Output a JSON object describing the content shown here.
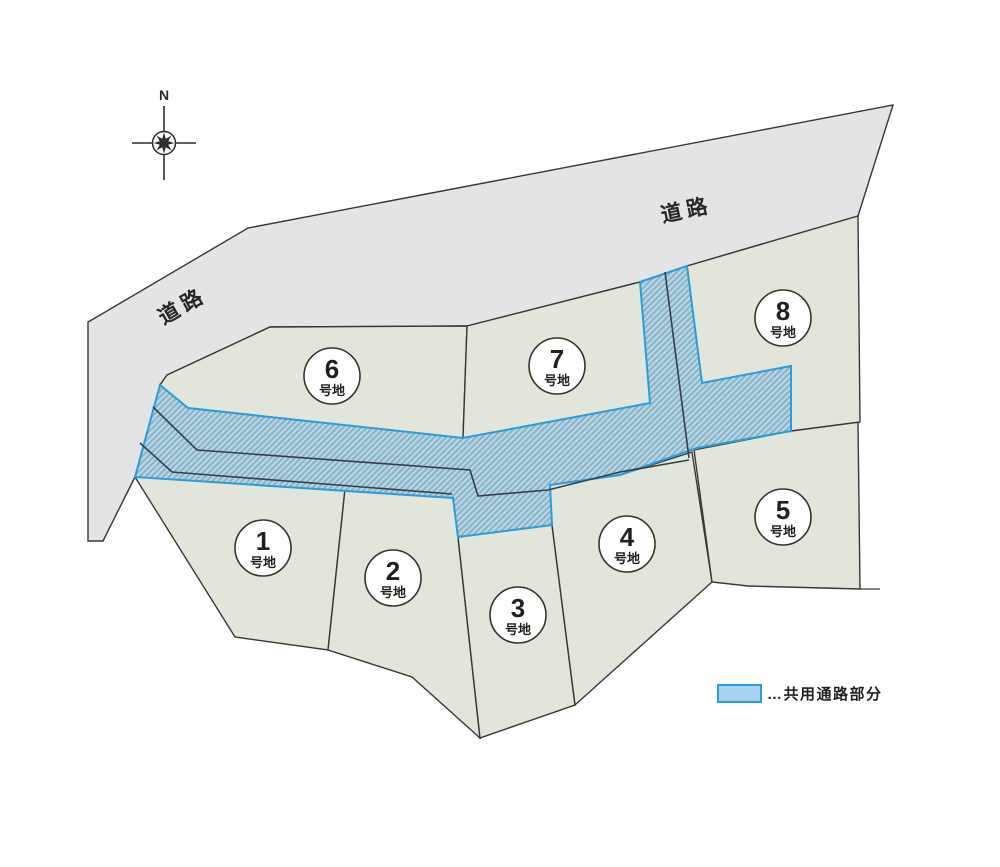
{
  "title": "分譲地区画図",
  "compass": {
    "north_label": "N"
  },
  "roads": [
    {
      "label": "道路",
      "position": "upper-left"
    },
    {
      "label": "道路",
      "position": "upper-right"
    }
  ],
  "plots": [
    {
      "number": "1",
      "suffix": "号地"
    },
    {
      "number": "2",
      "suffix": "号地"
    },
    {
      "number": "3",
      "suffix": "号地"
    },
    {
      "number": "4",
      "suffix": "号地"
    },
    {
      "number": "5",
      "suffix": "号地"
    },
    {
      "number": "6",
      "suffix": "号地"
    },
    {
      "number": "7",
      "suffix": "号地"
    },
    {
      "number": "8",
      "suffix": "号地"
    }
  ],
  "legend": {
    "label": "…共用通路部分"
  },
  "colors": {
    "road_fill": "#e4e4e6",
    "plot_fill": "#e1e5da",
    "passage_base": "#8ab2c6",
    "passage_stripe": "#b9d8e5",
    "passage_border": "#2b9dd8",
    "line_dark": "#3a3633"
  }
}
